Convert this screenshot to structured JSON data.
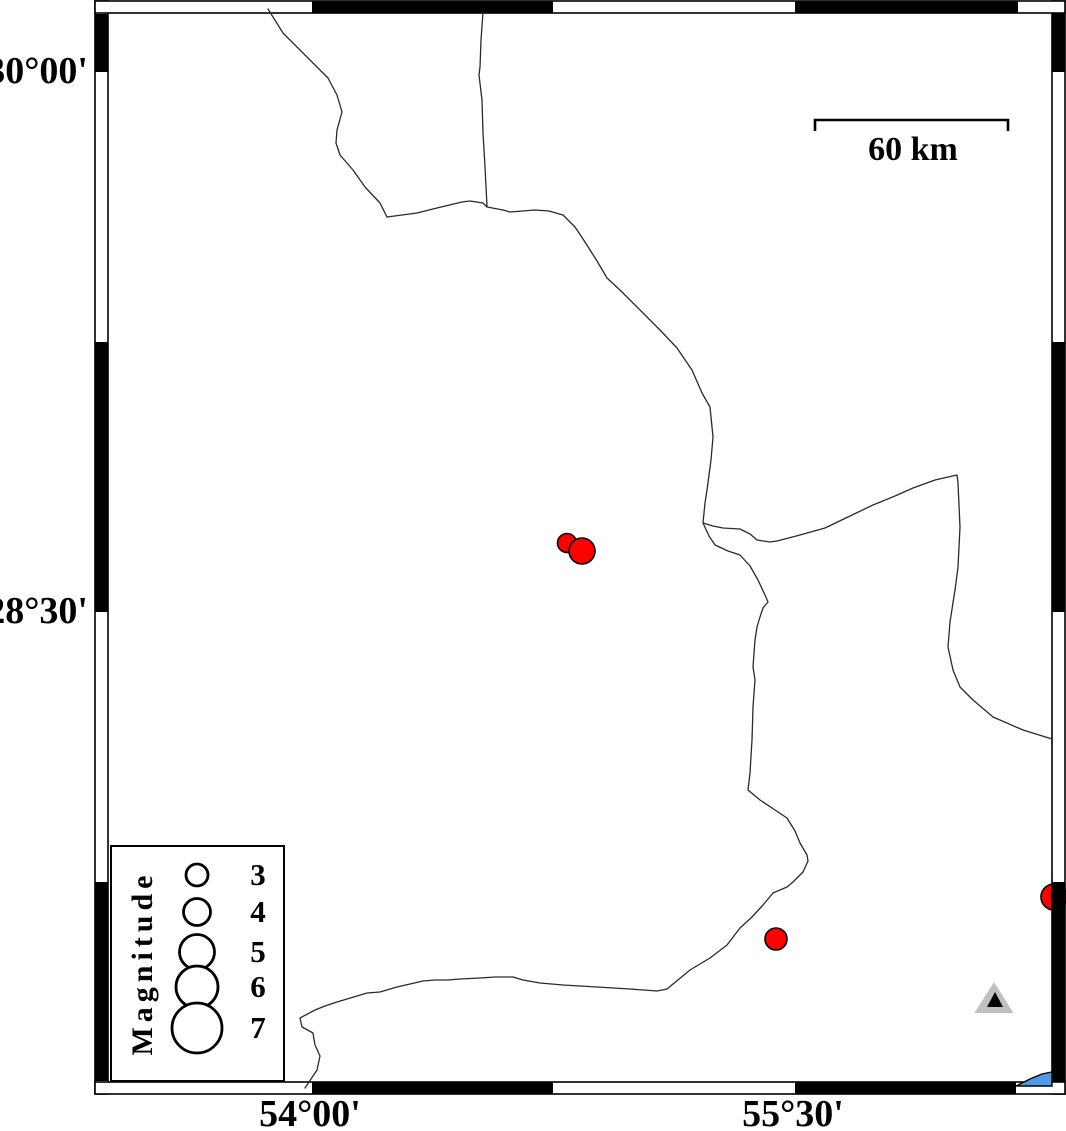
{
  "map_frame": {
    "outer": {
      "left": 95,
      "top": 1,
      "right": 1065,
      "bottom": 1094
    },
    "inner": {
      "left": 108,
      "top": 13,
      "right": 1052,
      "bottom": 1082
    },
    "y_annotations": [
      {
        "label": "30°00'",
        "y": 72
      },
      {
        "label": "28°30'",
        "y": 612
      }
    ],
    "x_annotations": [
      {
        "label": "54°00'",
        "x": 310
      },
      {
        "label": "55°30'",
        "x": 793
      }
    ],
    "top_black_segments": [
      [
        312,
        553
      ],
      [
        795,
        1018
      ]
    ],
    "bottom_black_segments": [
      [
        312,
        553
      ],
      [
        795,
        1016
      ]
    ],
    "left_black_segments": [
      [
        14,
        72
      ],
      [
        342,
        612
      ],
      [
        882,
        1081
      ]
    ],
    "right_black_segments": [
      [
        13,
        72
      ],
      [
        342,
        612
      ],
      [
        882,
        1082
      ]
    ]
  },
  "scale_bar": {
    "label": "60 km",
    "x1": 815,
    "x2": 1008,
    "y": 120,
    "tick_drop": 11
  },
  "legend": {
    "title": "Magnitude",
    "symbol_cx": 85,
    "label_cx": 146,
    "entries": [
      {
        "label": "3",
        "cy": 28,
        "r": 11
      },
      {
        "label": "4",
        "cy": 65,
        "r": 13.5
      },
      {
        "label": "5",
        "cy": 105,
        "r": 17.5
      },
      {
        "label": "6",
        "cy": 140,
        "r": 21
      },
      {
        "label": "7",
        "cy": 181,
        "r": 25
      }
    ]
  },
  "earthquakes": [
    {
      "x": 567,
      "y": 543,
      "r": 9.5
    },
    {
      "x": 582,
      "y": 551,
      "r": 13
    },
    {
      "x": 776,
      "y": 939,
      "r": 11
    },
    {
      "x": 1054,
      "y": 897,
      "r": 13
    }
  ],
  "stations": [
    {
      "cx": 994,
      "outer": {
        "apex_y": 982,
        "base_y": 1013,
        "half_w": 19.5
      },
      "inner": {
        "apex_y": 992,
        "base_y": 1007,
        "half_w": 8
      }
    }
  ],
  "water": {
    "points": "1016,1086 1030,1079 1042,1074 1052,1072 1052,1086"
  },
  "boundaries": [
    "M 268,9 L 283,33 L 305,55 L 328,78 L 337,95 L 342,112 L 337,130 L 336,143 L 340,155 L 353,170 L 365,187 L 380,203 L 387,217",
    "M 387,217 L 417,213 L 437,208 L 462,202 L 470,201 L 483,203 L 487,207 L 503,210 L 510,212 L 535,210 L 549,211 L 563,215 L 575,227 L 585,242 L 597,261 L 607,278 L 620,290 L 635,305 L 648,318 L 660,330 L 677,348 L 692,370 L 702,393 L 710,407 L 712,427 L 713,437 L 711,460 L 707,490 L 705,503 L 703,523",
    "M 483,12 L 481,40 L 480,67 L 479,75 L 482,100 L 483,133 L 485,167 L 487,206",
    "M 703,523 L 713,526 L 723,528 L 740,529 L 750,534 L 757,540 L 770,542 L 777,541 L 800,535 L 825,528 L 850,516 L 873,505 L 895,496 L 913,488 L 935,480 L 957,475 L 958,483 L 959,505 L 960,527 L 958,567 L 955,590 L 950,622 L 948,647 L 953,670 L 960,687 L 973,700 L 993,717 L 1023,730 L 1052,739",
    "M 703,523 L 709,536 L 715,545 L 728,551 L 740,555 L 750,566 L 758,580 L 765,595 L 768,602 L 763,608 L 760,617 L 757,627 L 755,640 L 753,667 L 755,680 L 753,707 L 752,740 L 750,773 L 748,790 L 760,800 L 775,810 L 787,818 L 795,831 L 800,843 L 807,855 L 808,861 L 803,872 L 793,882 L 787,887 L 773,893 L 763,905 L 752,917 L 740,928 L 727,945 L 710,958 L 690,970 L 667,989 L 657,991 L 630,989 L 597,987 L 563,985 L 540,983 L 523,980 L 513,977 L 495,977 L 480,978 L 460,979 L 448,980 L 435,980 L 423,981 L 410,984 L 397,987 L 380,992 L 367,993 L 337,1002 L 325,1006 L 315,1010 L 300,1018 L 302,1027 L 313,1033 L 315,1045 L 320,1056 L 317,1070 L 305,1088"
  ],
  "colors": {
    "epicenter_fill": "#ff0000",
    "symbol_stroke": "#000000",
    "station_outer": "#c0c0c0",
    "station_inner": "#000000",
    "water_fill": "#4d9be6",
    "boundary_line": "#2a2a2a",
    "frame": "#000000"
  }
}
